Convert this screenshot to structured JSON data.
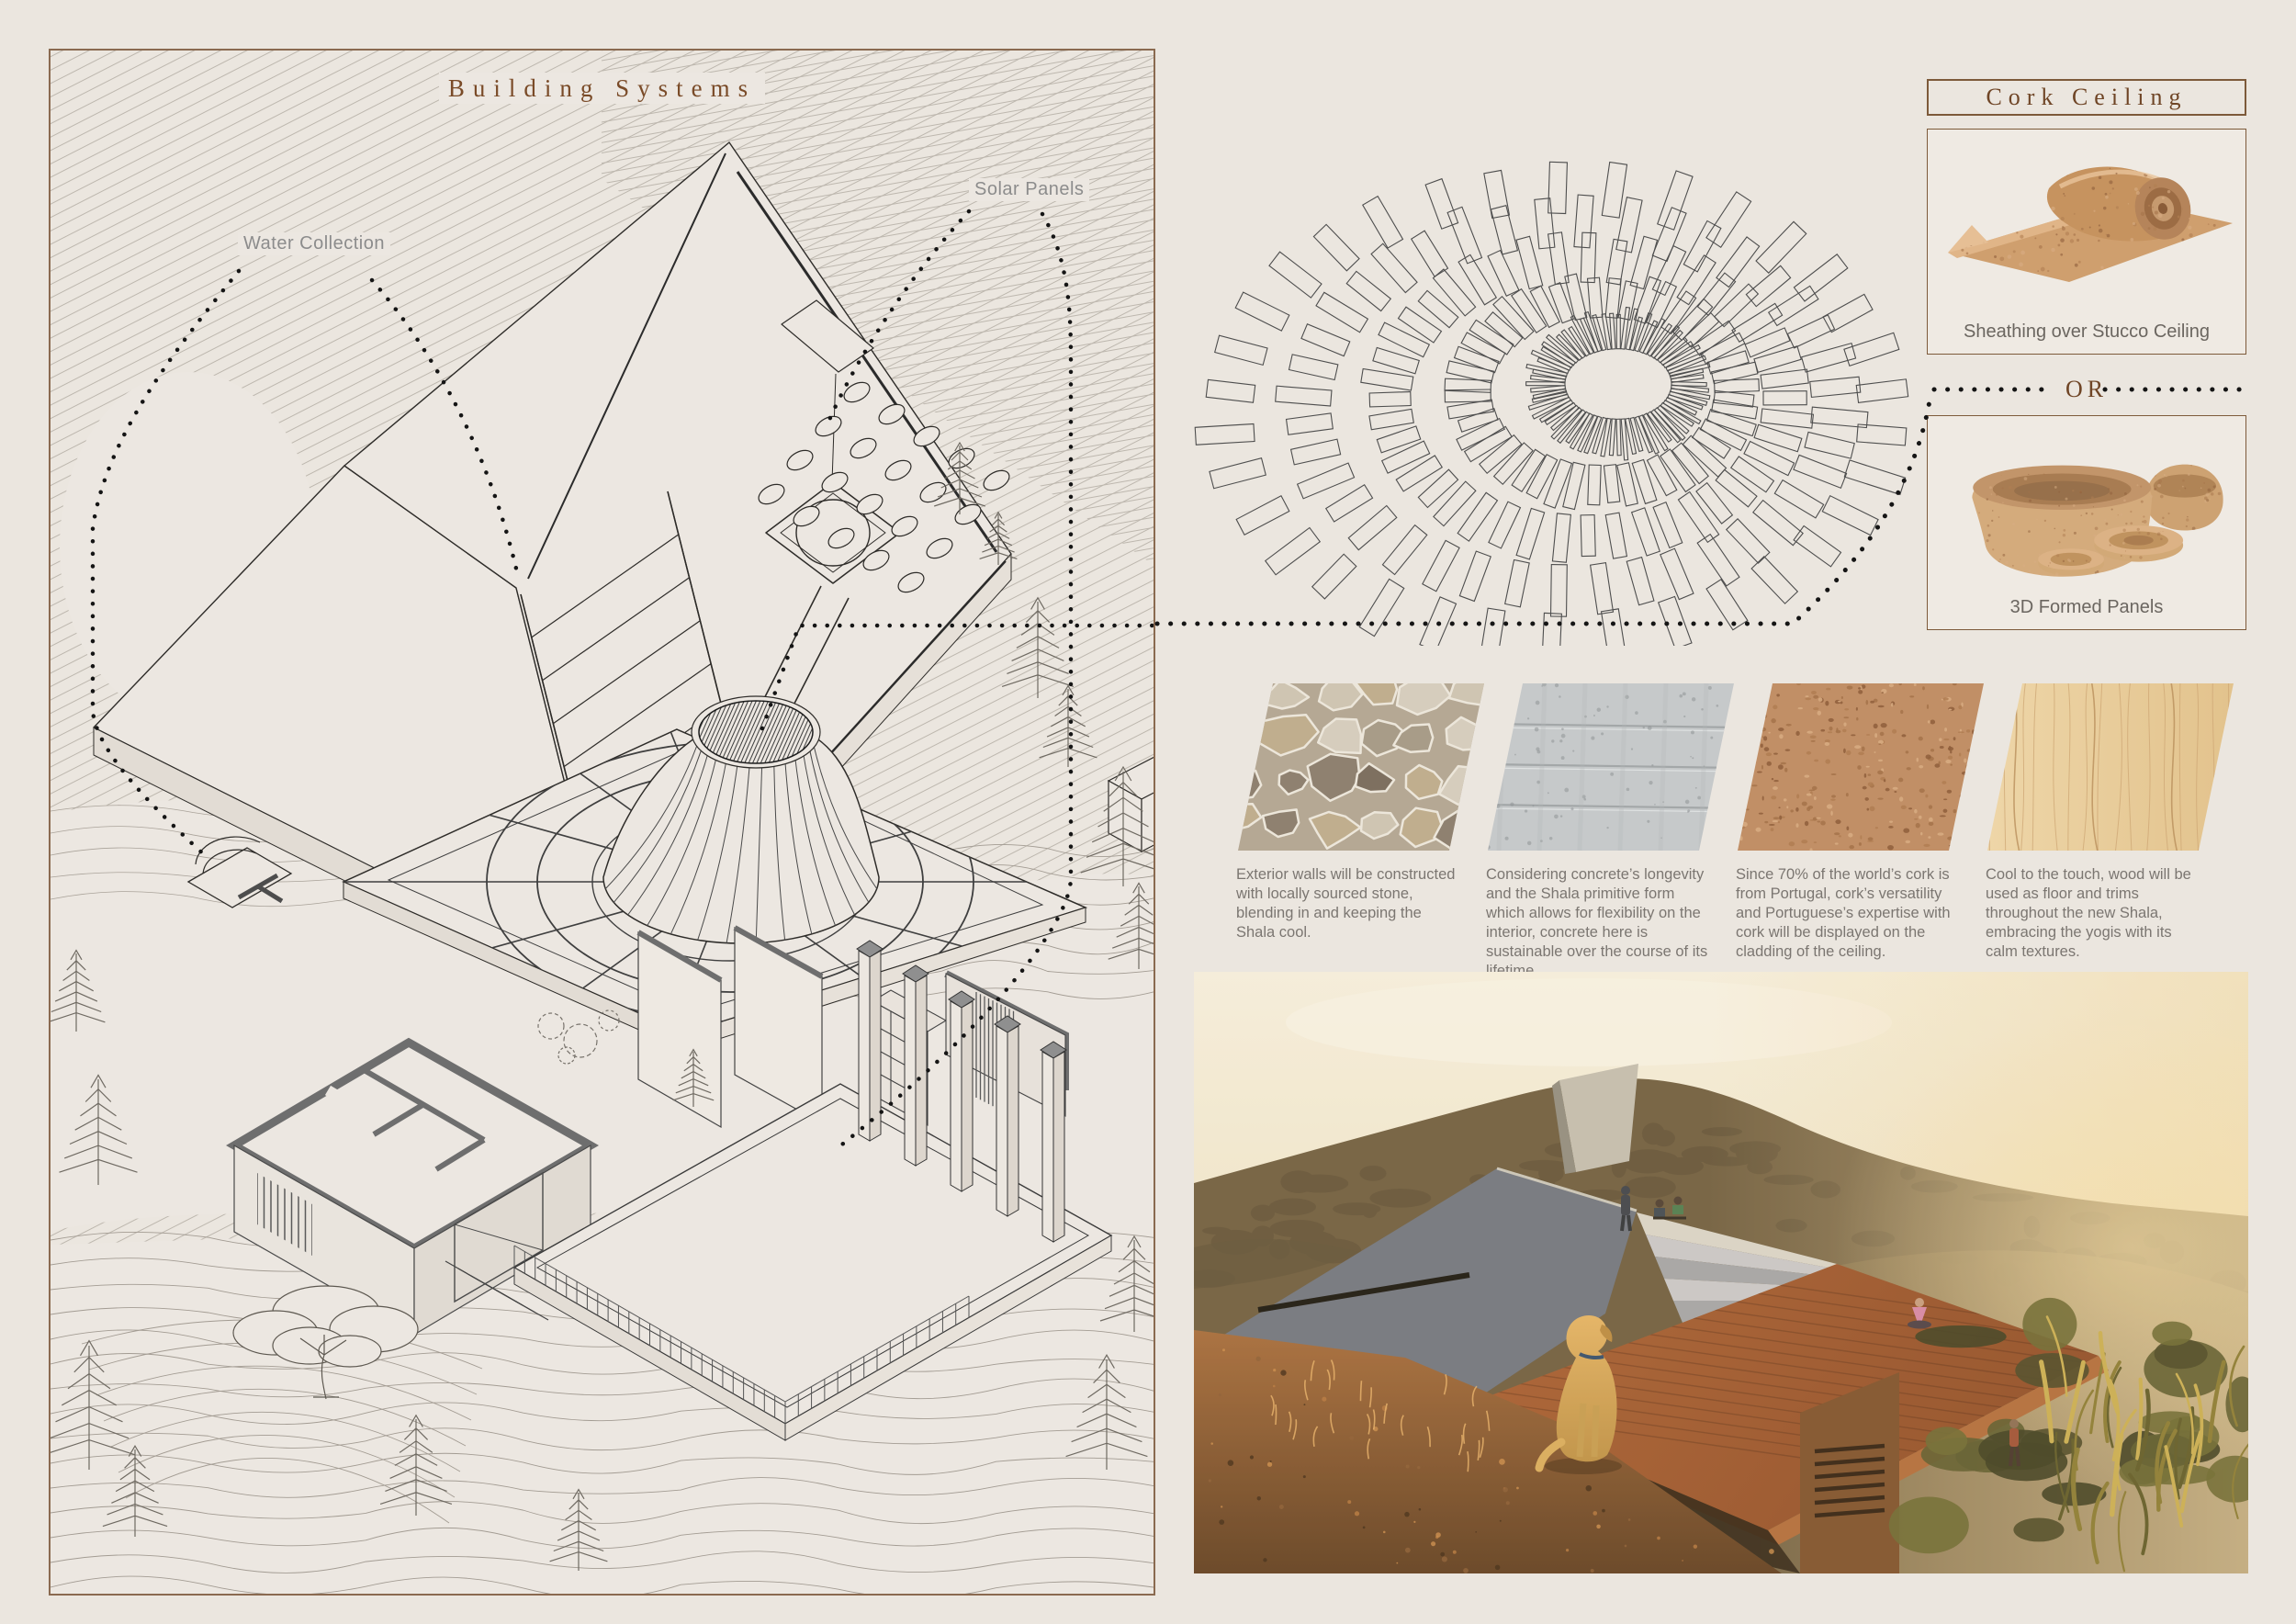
{
  "board": {
    "background": "#ebe6df",
    "panel_border": "#8a6a50",
    "accent_brown": "#7a4b28",
    "text_gray": "#7b7671",
    "label_gray": "#8c8c8c",
    "line_ink": "#2e2c29"
  },
  "building_systems": {
    "title": "Building Systems",
    "water_label": "Water Collection",
    "solar_label": "Solar Panels"
  },
  "cork_ceiling": {
    "title": "Cork Ceiling",
    "option_a_caption": "Sheathing over Stucco Ceiling",
    "divider_label": "OR",
    "option_b_caption": "3D Formed Panels"
  },
  "materials": [
    {
      "name": "stone",
      "description": "Exterior walls will be constructed with locally sourced stone, blending in and keeping the Shala cool."
    },
    {
      "name": "concrete",
      "description": "Considering concrete’s longevity and the Shala primitive form which allows for flexibility on the interior, concrete here is sustainable over the course of its lifetime."
    },
    {
      "name": "cork",
      "description": "Since 70% of the world’s cork is from Portugal, cork’s versatility and Portuguese’s expertise with cork will be displayed on the cladding of the ceiling."
    },
    {
      "name": "wood",
      "description": "Cool to the touch, wood will be used as floor and trims throughout the new Shala, embracing the yogis with its calm textures."
    }
  ],
  "decor": {
    "ceiling_pattern": {
      "center": [
        470,
        300
      ],
      "drift": [
        -17,
        8
      ],
      "ky": 0.66,
      "slat_color": "#4e4e4e",
      "rings": [
        {
          "r": 58,
          "len": 40,
          "w": 4,
          "n": 72
        },
        {
          "r": 122,
          "len": 46,
          "w": 13,
          "n": 48
        },
        {
          "r": 192,
          "len": 50,
          "w": 15,
          "n": 44
        },
        {
          "r": 262,
          "len": 54,
          "w": 17,
          "n": 40
        },
        {
          "r": 330,
          "len": 56,
          "w": 19,
          "n": 34
        }
      ]
    },
    "stone_palette": [
      "#cfc5b2",
      "#a89c88",
      "#8f8170",
      "#c0ae8e",
      "#d6cdbd",
      "#7e7060"
    ],
    "cork_palette": [
      "#a5734a",
      "#8f5f3c",
      "#d8ad83",
      "#b07e52"
    ],
    "wood_grain": [
      "#cfa977",
      "#b9905c"
    ],
    "concrete_speck": "#8f9496",
    "pines": [
      [
        990,
        505,
        0.75
      ],
      [
        1032,
        560,
        0.55
      ],
      [
        1075,
        705,
        1.05
      ],
      [
        1108,
        780,
        0.85
      ],
      [
        1168,
        910,
        1.25
      ],
      [
        28,
        1068,
        0.85
      ],
      [
        52,
        1235,
        1.15
      ],
      [
        42,
        1545,
        1.35
      ],
      [
        92,
        1618,
        0.95
      ],
      [
        398,
        1595,
        1.05
      ],
      [
        575,
        1655,
        0.85
      ],
      [
        700,
        1150,
        0.6
      ],
      [
        1185,
        1000,
        0.9
      ],
      [
        1180,
        1395,
        1.0
      ],
      [
        1150,
        1545,
        1.2
      ]
    ]
  }
}
